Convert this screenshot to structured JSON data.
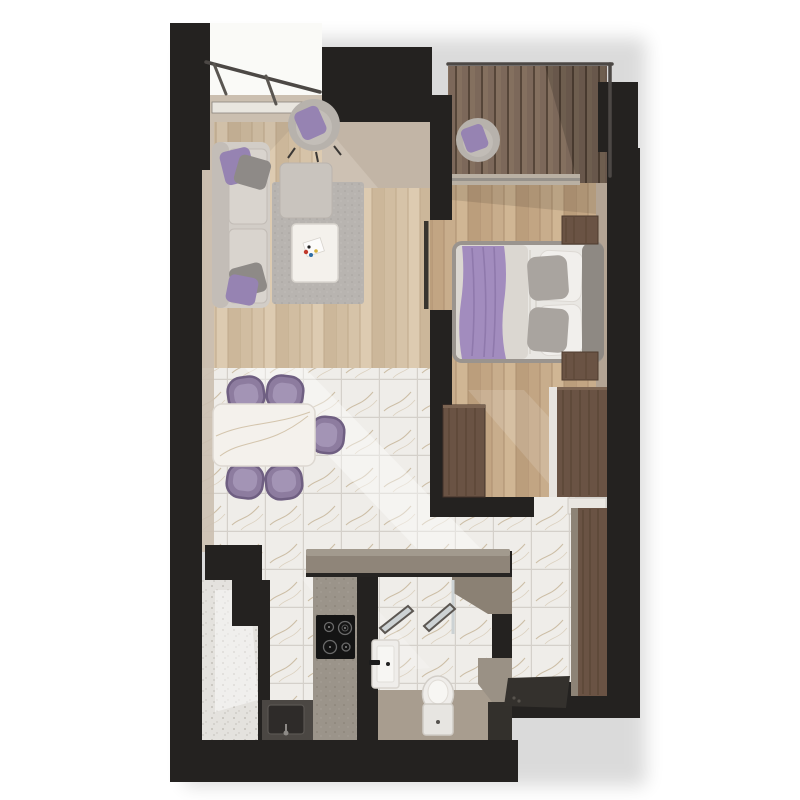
{
  "scene": {
    "type": "3d-floor-plan-render",
    "view": "top-down dollhouse view of a one-bedroom apartment",
    "background": "#ffffff"
  },
  "palette": {
    "wall": "#242220",
    "wallFace": "#cbbfb0",
    "wallFaceDark": "#b3a494",
    "woodLiving": "#d6c3a8",
    "woodLivingLine": "#c0aa8c",
    "woodBedroom": "#c8ad8c",
    "woodBedroomLine": "#ad9070",
    "deck": "#7c685a",
    "deckLine": "#564639",
    "marble": "#efede9",
    "marbleGrout": "#d4d0ca",
    "marbleVein": "#a98f63",
    "terrazzo": "#e4e2de",
    "terrazzoDot": "#b9b5af",
    "counter": "#8f8579",
    "counterLight": "#a29a8e",
    "counterDark": "#4b4743",
    "rug": "#b8b4b0",
    "sofa": "#d2cdc7",
    "sofaSeat": "#d9d4ce",
    "ottoman": "#c9c4be",
    "armchair": "#b7b2ac",
    "pillowPurple": "#9683b2",
    "pillowGray": "#8e8a87",
    "chairPurple": "#8d7c9f",
    "chairPurpleDark": "#6f5f82",
    "chairCushion": "#a394b5",
    "tableWhite": "#f4f1ec",
    "duvet": "#e9e7e3",
    "duvetShade": "#dbd7d1",
    "blanketPurple": "#a28cbe",
    "blanketFold": "#8b74a8",
    "headboard": "#8e8983",
    "bedFrame": "#9a948e",
    "furnWood": "#6a5344",
    "furnWoodDark": "#4e3b2e",
    "fixtureWhite": "#efedea",
    "bathFloor": "#a89d8f",
    "cooktop": "#141414",
    "mat": "#34312d",
    "railing": "#4c4845",
    "glass": "#ccd2d4"
  },
  "rooms": [
    {
      "name": "living-room",
      "floor": "light oak planks",
      "furniture": [
        "gray sofa with purple and gray cushions",
        "gray ottoman",
        "round swivel armchair with purple pillow",
        "gray rug",
        "white coffee table with decor"
      ]
    },
    {
      "name": "dining-area",
      "floor": "white marble tile",
      "furniture": [
        "white marble dining table",
        "five purple tub chairs"
      ]
    },
    {
      "name": "bedroom",
      "floor": "oak planks",
      "furniture": [
        "double bed with white duvet, gray pillows and purple throw",
        "two walnut nightstands",
        "walnut wardrobe with white side panel",
        "walnut cabinet"
      ]
    },
    {
      "name": "kitchen",
      "floor": "white marble tile",
      "furniture": [
        "taupe peninsula counter",
        "black four-burner cooktop",
        "dark counter with sink and faucet"
      ]
    },
    {
      "name": "bathroom",
      "floor": "marble tile and greige screed",
      "furniture": [
        "wall-hung washbasin with black faucet",
        "toilet",
        "two leaning framed mirrors",
        "corner shower with bench"
      ]
    },
    {
      "name": "hallway",
      "floor": "white marble tile",
      "furniture": [
        "walnut wardrobe",
        "dark entrance mat",
        "white bedroom door leaf"
      ]
    },
    {
      "name": "balcony-top-left",
      "floor": "bright concrete",
      "furniture": [
        "glass railing"
      ]
    },
    {
      "name": "balcony-top-right",
      "floor": "dark wood decking",
      "furniture": [
        "round armchair with purple pillow",
        "glass railing"
      ]
    },
    {
      "name": "utility-balcony",
      "floor": "speckled terrazzo",
      "furniture": []
    }
  ]
}
